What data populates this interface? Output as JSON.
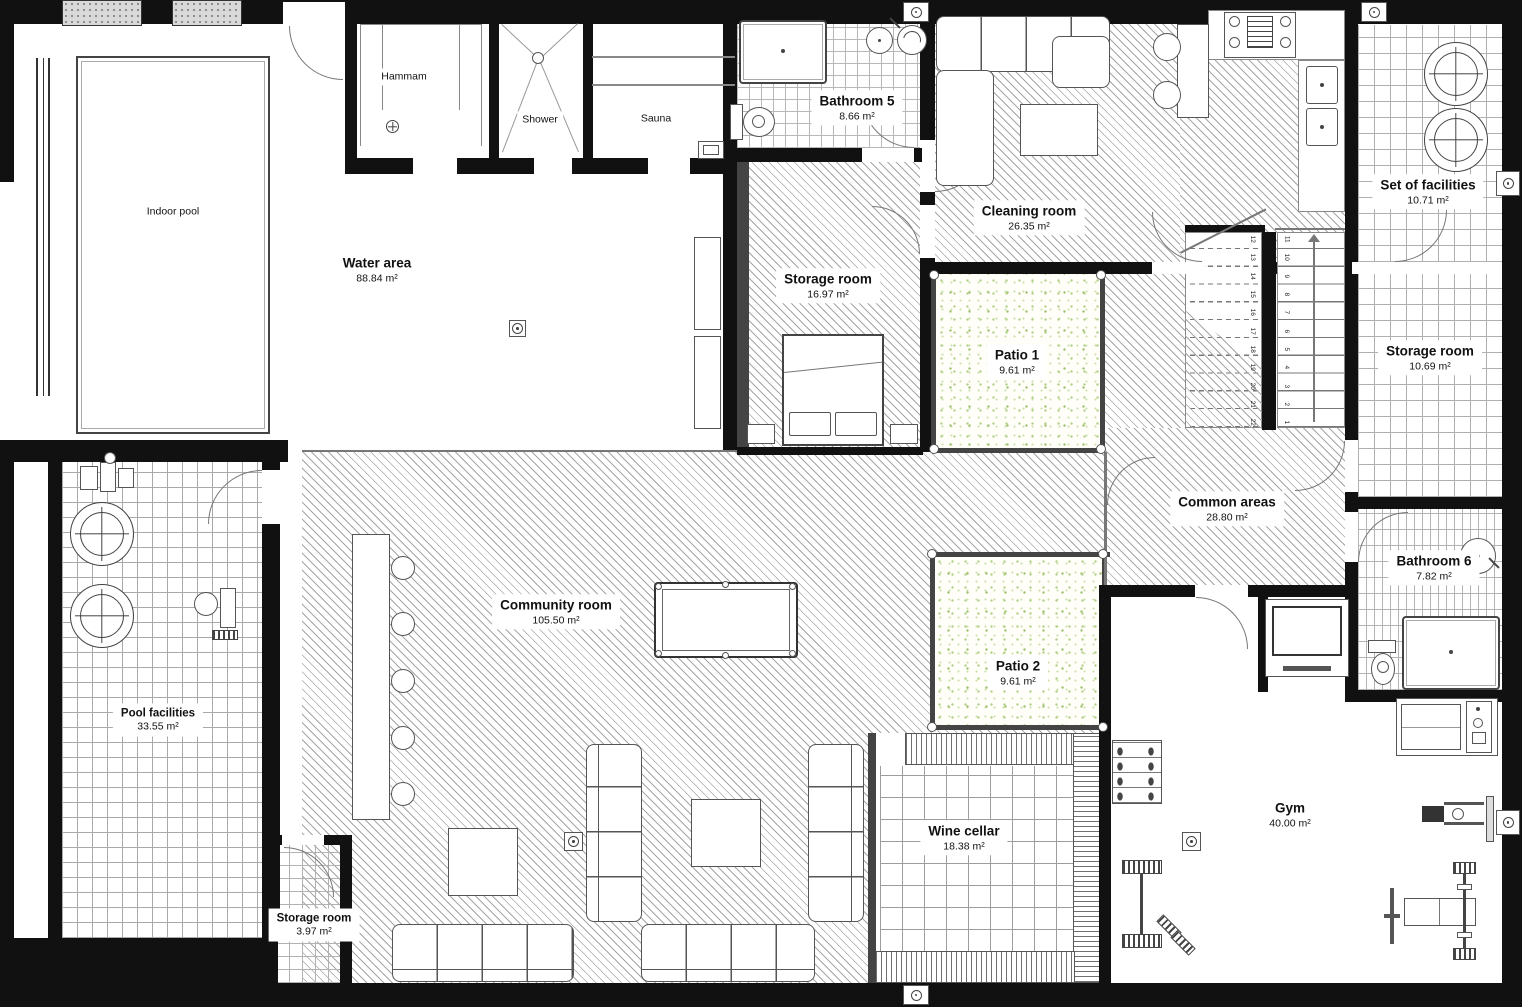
{
  "rooms": {
    "indoor_pool": {
      "label": "Indoor pool"
    },
    "water_area": {
      "label": "Water area",
      "area": "88.84 m²"
    },
    "hammam": {
      "label": "Hammam"
    },
    "shower": {
      "label": "Shower"
    },
    "sauna": {
      "label": "Sauna"
    },
    "bathroom_5": {
      "label": "Bathroom 5",
      "area": "8.66 m²"
    },
    "cleaning_room": {
      "label": "Cleaning room",
      "area": "26.35 m²"
    },
    "storage_room_1": {
      "label": "Storage room",
      "area": "16.97 m²"
    },
    "patio_1": {
      "label": "Patio 1",
      "area": "9.61 m²"
    },
    "set_of_facilities": {
      "label": "Set of facilities",
      "area": "10.71 m²"
    },
    "storage_room_2": {
      "label": "Storage room",
      "area": "10.69 m²"
    },
    "common_areas": {
      "label": "Common areas",
      "area": "28.80 m²"
    },
    "bathroom_6": {
      "label": "Bathroom 6",
      "area": "7.82 m²"
    },
    "pool_facilities": {
      "label": "Pool facilities",
      "area": "33.55 m²"
    },
    "community_room": {
      "label": "Community room",
      "area": "105.50 m²"
    },
    "patio_2": {
      "label": "Patio 2",
      "area": "9.61 m²"
    },
    "wine_cellar": {
      "label": "Wine cellar",
      "area": "18.38 m²"
    },
    "gym": {
      "label": "Gym",
      "area": "40.00 m²"
    },
    "storage_room_3": {
      "label": "Storage room",
      "area": "3.97 m²"
    }
  },
  "stairs": {
    "right_flight": [
      "1",
      "2",
      "3",
      "4",
      "5",
      "6",
      "7",
      "8",
      "9",
      "10",
      "11"
    ],
    "left_flight": [
      "12",
      "13",
      "14",
      "15",
      "16",
      "17",
      "18",
      "19",
      "20",
      "21",
      "22"
    ]
  },
  "colors": {
    "wall": "#111111",
    "hatch_line": "#a6a6a6",
    "tile_line": "#b8b8b8",
    "patio_green": "#9cc06b"
  }
}
